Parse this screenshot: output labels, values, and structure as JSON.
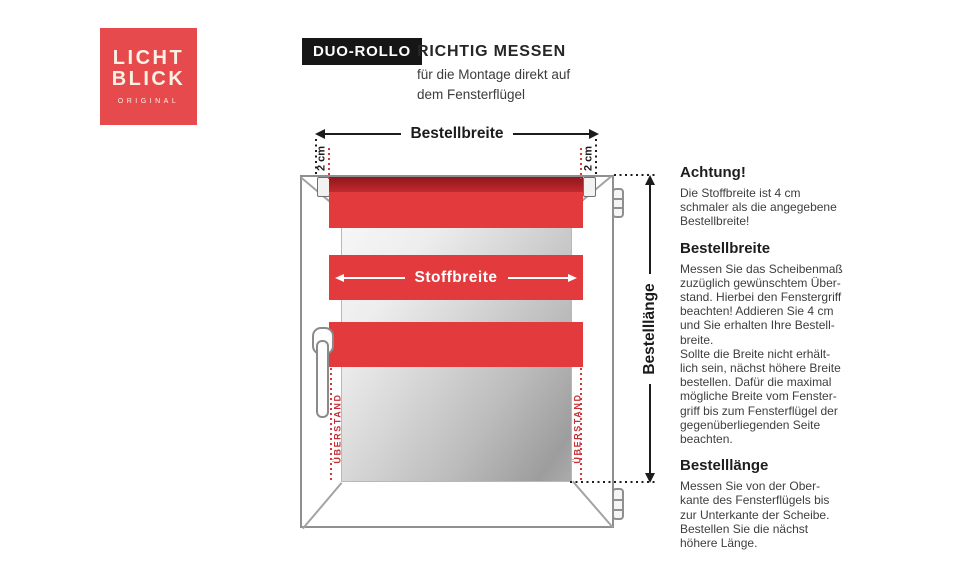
{
  "logo": {
    "line1": "LICHT",
    "line2": "BLICK",
    "subtitle": "ORIGINAL",
    "bg_color": "#e64a4c"
  },
  "header": {
    "badge": "DUO-ROLLO",
    "title": "RICHTIG MESSEN",
    "subtitle": "für die Montage direkt auf\ndem Fensterflügel"
  },
  "diagram": {
    "labels": {
      "bestellbreite": "Bestellbreite",
      "stoffbreite": "Stoffbreite",
      "bestelllaenge": "Bestelllänge",
      "two_cm_left": "2 cm",
      "two_cm_right": "2 cm",
      "ueberstand_left": "ÜBERSTAND",
      "ueberstand_right": "ÜBERSTAND"
    },
    "colors": {
      "fabric_red": "#e23a3d",
      "roller_dark_red": "#a81f24",
      "dotted_red": "#d2383c",
      "measure_black": "#1c1c1c"
    }
  },
  "sidebar": {
    "sections": [
      {
        "heading": "Achtung!",
        "body": "Die Stoffbreite ist 4 cm\nschmaler als die angegebene\nBestellbreite!"
      },
      {
        "heading": "Bestellbreite",
        "body": "Messen Sie das Scheibenmaß\nzuzüglich gewünschtem Über-\nstand. Hierbei den Fenstergriff\nbeachten! Addieren Sie 4 cm\nund Sie erhalten Ihre Bestell-\nbreite.\nSollte die Breite nicht erhält-\nlich sein, nächst höhere Breite\nbestellen. Dafür die maximal\nmögliche Breite vom Fenster-\ngriff bis zum Fensterflügel der\ngegenüberliegenden Seite\nbeachten."
      },
      {
        "heading": "Bestelllänge",
        "body": "Messen Sie von der Ober-\nkante des Fensterflügels bis\nzur Unterkante der Scheibe.\nBestellen Sie die nächst\nhöhere Länge."
      }
    ]
  }
}
